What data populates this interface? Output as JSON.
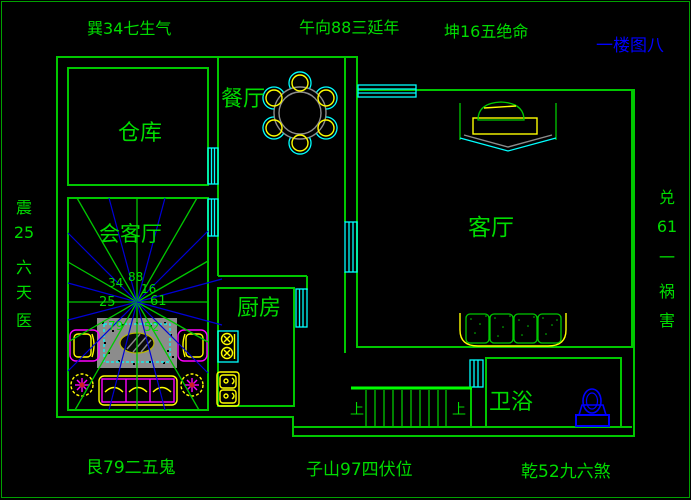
{
  "title": {
    "text": "一楼图八"
  },
  "compass": {
    "top_left": "巽34七生气",
    "top_center": "午向88三延年",
    "top_right": "坤16五绝命",
    "bottom_left": "艮79二五鬼",
    "bottom_center": "子山97四伏位",
    "bottom_right": "乾52九六煞",
    "left": [
      "震",
      "25",
      "六",
      "天",
      "医"
    ],
    "right": [
      "兑",
      "61",
      "一",
      "祸",
      "害"
    ]
  },
  "rooms": {
    "storage": "仓库",
    "dining": "餐厅",
    "reception": "会客厅",
    "kitchen": "厨房",
    "living": "客厅",
    "bathroom": "卫浴"
  },
  "stairs": {
    "up_label": "上"
  },
  "fan_numbers": [
    "34",
    "88",
    "16",
    "25",
    "61",
    "79",
    "52"
  ],
  "colors": {
    "wall_green": "#00c800",
    "text_green": "#00dc00",
    "title_blue": "#0000ff",
    "window_cyan": "#00ffff",
    "furniture_yellow": "#ffff00",
    "sofa_magenta": "#ff00ff",
    "ray_blue": "#0000d8",
    "carpet_gray": "#8c8c8c"
  }
}
